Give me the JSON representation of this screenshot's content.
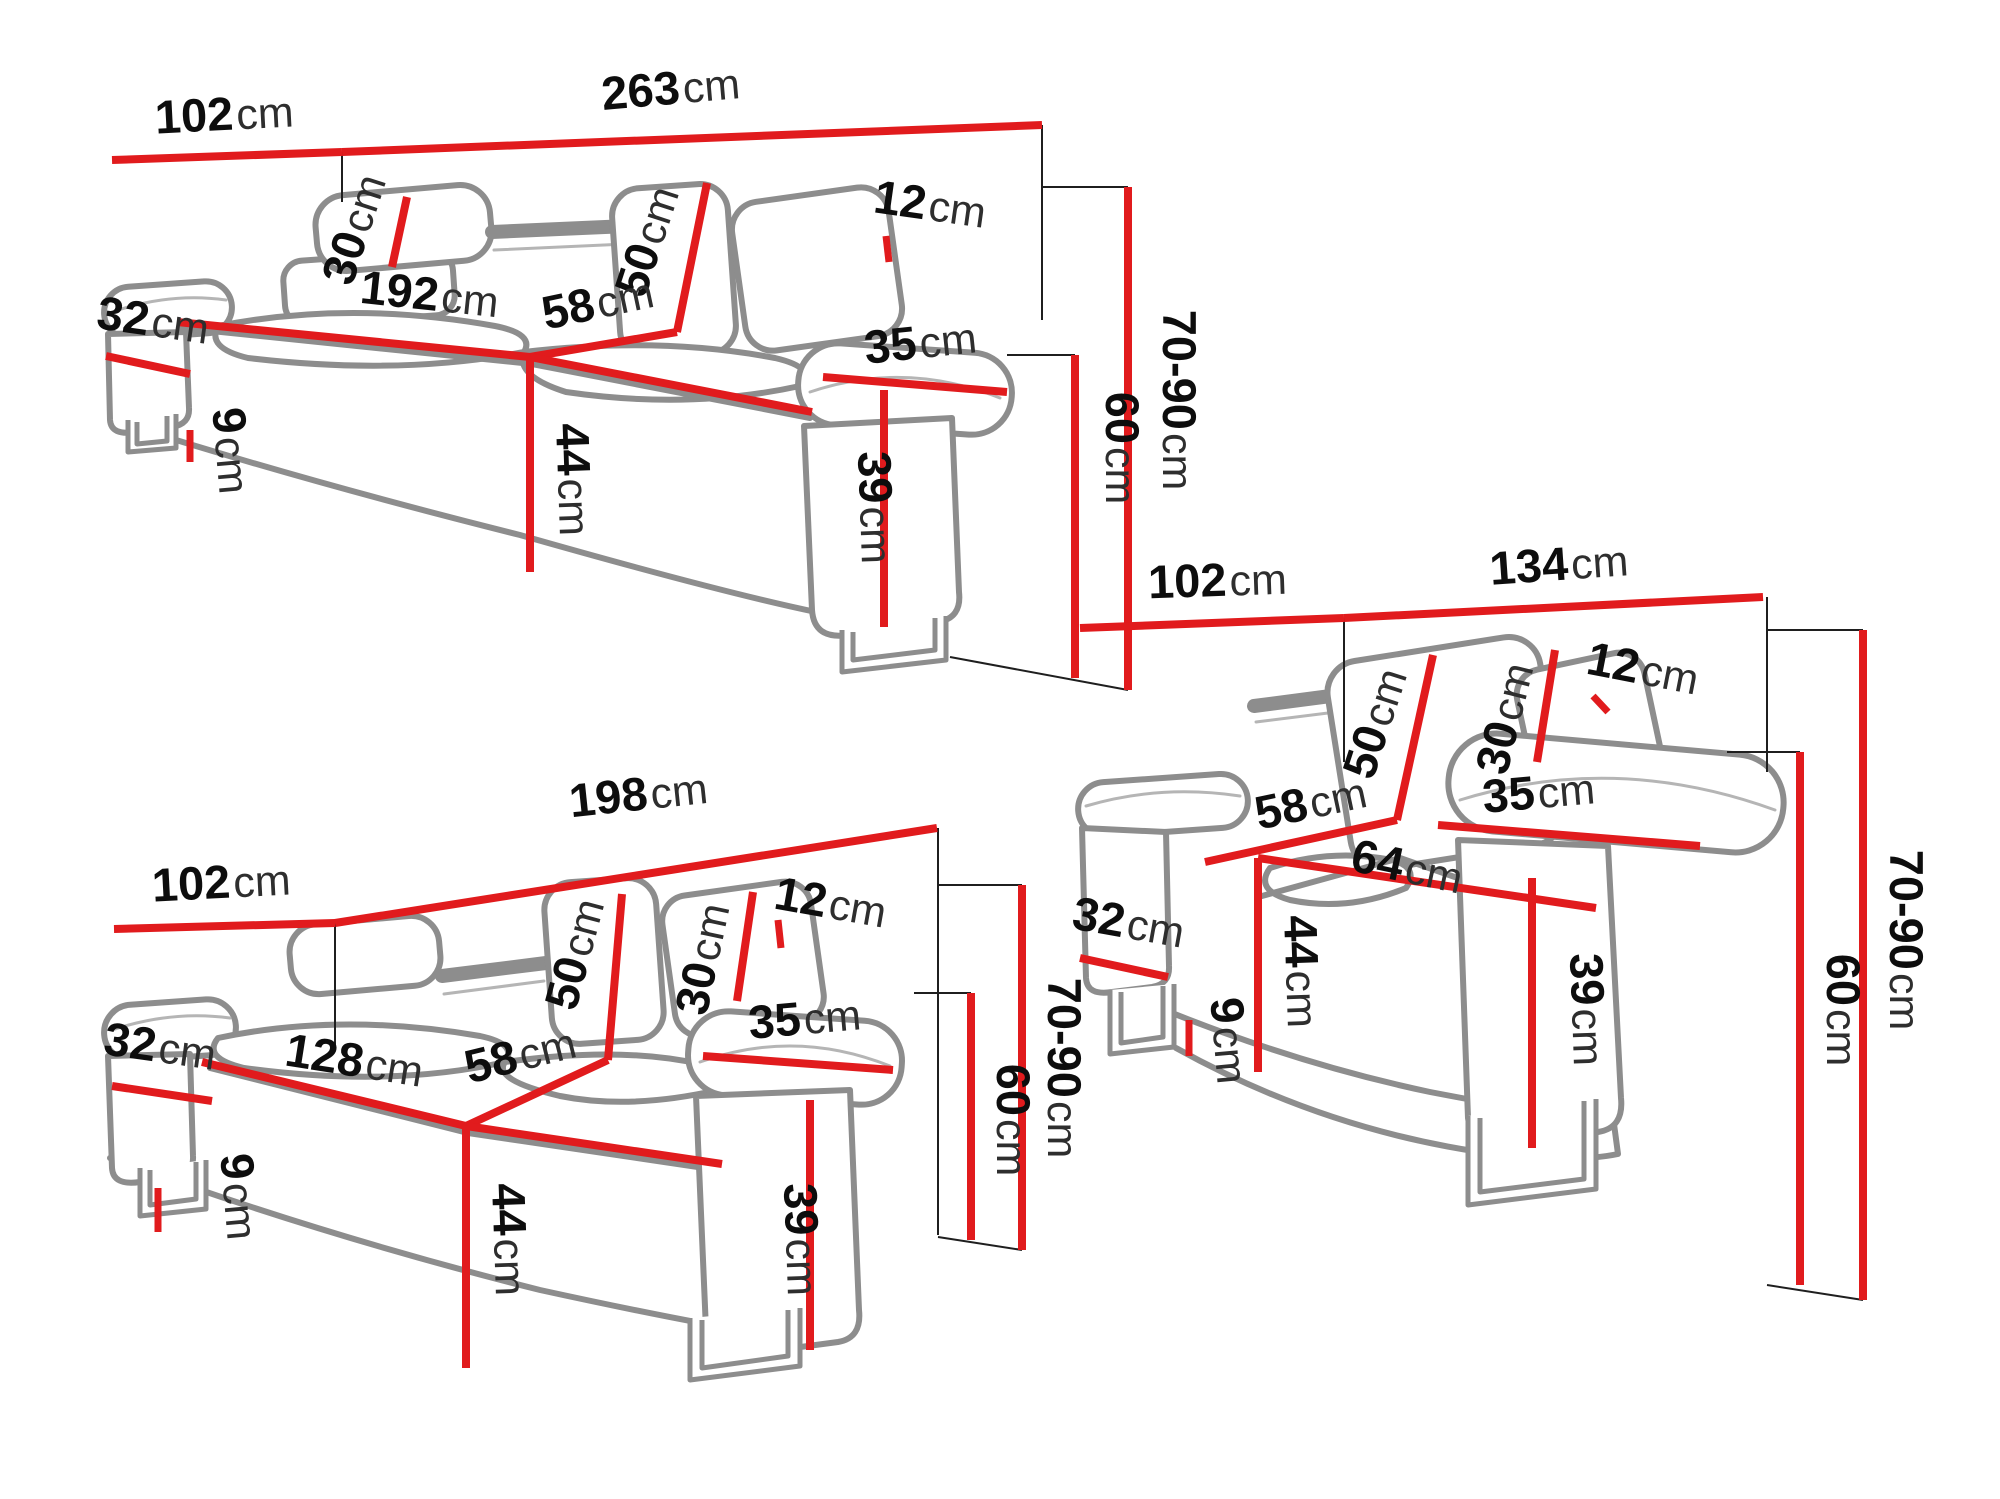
{
  "colors": {
    "red": "#e11b1d",
    "outline": "#8d8d8d",
    "detail": "#b5b5b5",
    "thin": "#1f1f1f",
    "number": "#0d0d0d",
    "unit": "#2e2e2e",
    "background": "#ffffff"
  },
  "figures": [
    {
      "id": "three-seater-sofa",
      "dims": {
        "depth": {
          "num": "102",
          "unit": "cm"
        },
        "width": {
          "num": "263",
          "unit": "cm"
        },
        "headrest": {
          "num": "12",
          "unit": "cm"
        },
        "back_pad": {
          "num": "30",
          "unit": "cm"
        },
        "backrest": {
          "num": "50",
          "unit": "cm"
        },
        "seat_width": {
          "num": "192",
          "unit": "cm"
        },
        "seat_depth": {
          "num": "58",
          "unit": "cm"
        },
        "armrest_top": {
          "num": "35",
          "unit": "cm"
        },
        "armrest_side": {
          "num": "32",
          "unit": "cm"
        },
        "height": {
          "num": "70-90",
          "unit": "cm"
        },
        "back_height": {
          "num": "60",
          "unit": "cm"
        },
        "legs": {
          "num": "9",
          "unit": "cm"
        },
        "seat_height": {
          "num": "44",
          "unit": "cm"
        },
        "armrest_height": {
          "num": "39",
          "unit": "cm"
        }
      }
    },
    {
      "id": "two-seater-sofa",
      "dims": {
        "depth": {
          "num": "102",
          "unit": "cm"
        },
        "width": {
          "num": "198",
          "unit": "cm"
        },
        "headrest": {
          "num": "12",
          "unit": "cm"
        },
        "back_pad": {
          "num": "30",
          "unit": "cm"
        },
        "backrest": {
          "num": "50",
          "unit": "cm"
        },
        "seat_width": {
          "num": "128",
          "unit": "cm"
        },
        "seat_depth": {
          "num": "58",
          "unit": "cm"
        },
        "armrest_top": {
          "num": "35",
          "unit": "cm"
        },
        "armrest_side": {
          "num": "32",
          "unit": "cm"
        },
        "height": {
          "num": "70-90",
          "unit": "cm"
        },
        "back_height": {
          "num": "60",
          "unit": "cm"
        },
        "legs": {
          "num": "9",
          "unit": "cm"
        },
        "seat_height": {
          "num": "44",
          "unit": "cm"
        },
        "armrest_height": {
          "num": "39",
          "unit": "cm"
        }
      }
    },
    {
      "id": "armchair",
      "dims": {
        "depth": {
          "num": "102",
          "unit": "cm"
        },
        "width": {
          "num": "134",
          "unit": "cm"
        },
        "headrest": {
          "num": "12",
          "unit": "cm"
        },
        "back_pad": {
          "num": "30",
          "unit": "cm"
        },
        "backrest": {
          "num": "50",
          "unit": "cm"
        },
        "seat_depth": {
          "num": "58",
          "unit": "cm"
        },
        "seat_width": {
          "num": "64",
          "unit": "cm"
        },
        "armrest_top": {
          "num": "35",
          "unit": "cm"
        },
        "armrest_side": {
          "num": "32",
          "unit": "cm"
        },
        "height": {
          "num": "70-90",
          "unit": "cm"
        },
        "back_height": {
          "num": "60",
          "unit": "cm"
        },
        "legs": {
          "num": "9",
          "unit": "cm"
        },
        "seat_height": {
          "num": "44",
          "unit": "cm"
        },
        "armrest_height": {
          "num": "39",
          "unit": "cm"
        }
      }
    }
  ]
}
